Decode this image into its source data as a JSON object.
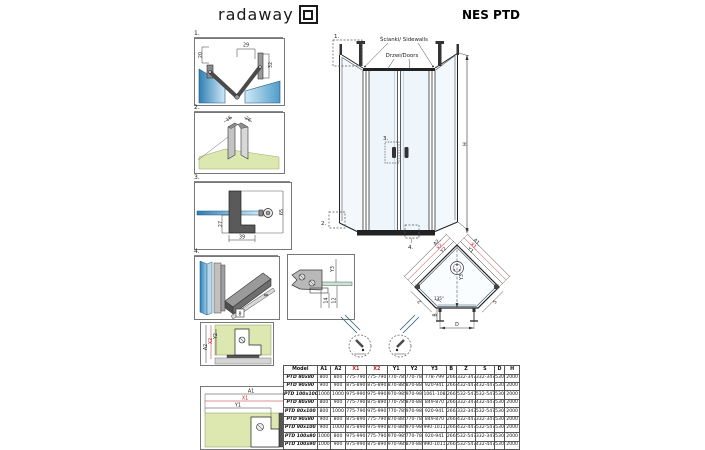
{
  "header": {
    "brand": "radaway",
    "title": "NES PTD"
  },
  "elevation": {
    "sidewalls_label": "Ścianki/ Sidewalls",
    "doors_label": "Drzwi/Doors",
    "h_dim": "H",
    "marker_1": "1.",
    "marker_2": "2.",
    "marker_3": "3.",
    "marker_4": "4."
  },
  "detail_1": {
    "number": "1.",
    "dim_left": "20",
    "dim_top": "29",
    "dim_right": "32"
  },
  "detail_2": {
    "number": "2.",
    "dim_left": "16",
    "dim_right": "26"
  },
  "detail_3": {
    "number": "3.",
    "dim_left": "27",
    "dim_bottom": "39",
    "dim_right": "65"
  },
  "detail_4": {
    "number": "4.",
    "dim_box": "8",
    "dim_side": "8"
  },
  "hinge_detail": {
    "dim_y3": "Y3",
    "dim_14": "14",
    "dim_12": "12"
  },
  "wall_vertical": {
    "dim_a2": "A2",
    "dim_x2": "X2",
    "dim_y2": "Y2"
  },
  "wall_horizontal": {
    "dim_a1": "A1",
    "dim_x1": "X1",
    "dim_y1": "Y1"
  },
  "plan": {
    "label_a2": "A2,",
    "label_x2": "X2,",
    "label_y2": "Y2",
    "label_a1": "A1,",
    "label_x1": "X1,",
    "label_y1": "Y1",
    "dim_y3": "Y3",
    "dim_b": "B",
    "dim_d": "D",
    "dim_z": "Z",
    "dim_s": "S",
    "angle": "135°"
  },
  "table": {
    "headers": [
      "Model",
      "A1",
      "A2",
      "X1",
      "X2",
      "Y1",
      "Y2",
      "Y3",
      "B",
      "Z",
      "S",
      "D",
      "H"
    ],
    "red_columns": [
      3,
      4
    ],
    "rows": [
      [
        "PTD 80x80",
        "800",
        "800",
        "775-790",
        "775-790",
        "770-785",
        "770-785",
        "778-799",
        "266",
        "332-347",
        "332-347",
        "530",
        "2000"
      ],
      [
        "PTD 90x90",
        "900",
        "900",
        "875-890",
        "875-890",
        "870-885",
        "870-885",
        "920-941",
        "266",
        "432-447",
        "432-447",
        "530",
        "2000"
      ],
      [
        "PTD 100x100",
        "1000",
        "1000",
        "975-990",
        "975-990",
        "970-985",
        "970-985",
        "1061-1082",
        "266",
        "532-547",
        "532-547",
        "530",
        "2000"
      ],
      [
        "PTD 80x90",
        "800",
        "900",
        "775-790",
        "875-890",
        "770-785",
        "870-885",
        "849-870",
        "266",
        "332-347",
        "432-447",
        "530",
        "2000"
      ],
      [
        "PTD 80x100",
        "800",
        "1000",
        "775-790",
        "975-990",
        "770-785",
        "970-985",
        "920-941",
        "266",
        "332-347",
        "532-547",
        "530",
        "2000"
      ],
      [
        "PTD 90x80",
        "900",
        "800",
        "875-890",
        "775-790",
        "870-885",
        "770-785",
        "849-870",
        "266",
        "432-447",
        "332-347",
        "530",
        "2000"
      ],
      [
        "PTD 90x100",
        "900",
        "1000",
        "875-890",
        "975-990",
        "870-885",
        "970-985",
        "990-1011",
        "266",
        "432-447",
        "532-547",
        "530",
        "2000"
      ],
      [
        "PTD 100x80",
        "1000",
        "800",
        "975-990",
        "775-790",
        "970-985",
        "770-785",
        "920-941",
        "266",
        "532-547",
        "332-347",
        "530",
        "2000"
      ],
      [
        "PTD 100x90",
        "1000",
        "900",
        "975-990",
        "875-890",
        "970-985",
        "870-885",
        "990-1011",
        "266",
        "532-547",
        "432-447",
        "530",
        "2000"
      ]
    ]
  },
  "colors": {
    "glass_blue": "#4f9cc9",
    "glass_light": "#cfe9f7",
    "wall_green": "#dde8b0",
    "floor_gray": "#cccccc",
    "profile_gray": "#9a9a9a",
    "dim_red": "#c22222",
    "line_dark": "#1a1a1a"
  }
}
